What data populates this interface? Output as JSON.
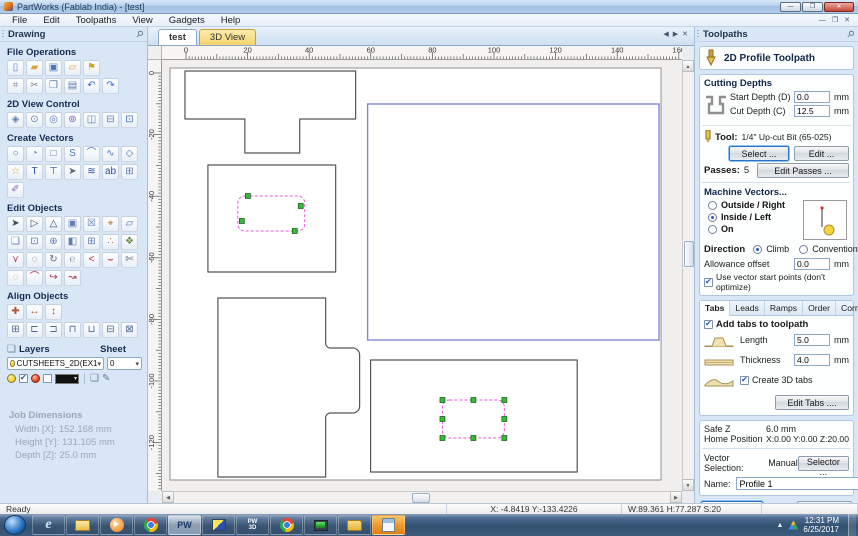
{
  "window": {
    "title": "PartWorks (Fablab India) - [test]"
  },
  "icons": {
    "minimize": "—",
    "restore": "❐",
    "close": "✕",
    "pin": "⚲",
    "arrow_left": "◀",
    "arrow_right": "▶",
    "up": "▲",
    "down": "▼",
    "left": "◀",
    "right": "▶",
    "caret": "▾",
    "play": "▶",
    "layers_stack": "❏",
    "layer_edit": "✎",
    "layers_head": "❏"
  },
  "menu": [
    {
      "name": "menu-file",
      "label": "File"
    },
    {
      "name": "menu-edit",
      "label": "Edit"
    },
    {
      "name": "menu-toolpaths",
      "label": "Toolpaths"
    },
    {
      "name": "menu-view",
      "label": "View"
    },
    {
      "name": "menu-gadgets",
      "label": "Gadgets"
    },
    {
      "name": "menu-help",
      "label": "Help"
    }
  ],
  "left_panel": {
    "header": "Drawing",
    "sections": {
      "file_operations": "File Operations",
      "view_control": "2D View Control",
      "create_vectors": "Create Vectors",
      "edit_objects": "Edit Objects",
      "align_objects": "Align Objects"
    },
    "file_ops_row1": [
      {
        "name": "new-file-icon",
        "g": "▯",
        "c": "#5f7fb5"
      },
      {
        "name": "open-file-icon",
        "g": "▰",
        "c": "#dca63e"
      },
      {
        "name": "save-file-icon",
        "g": "▣",
        "c": "#4f74b8"
      },
      {
        "name": "import-vectors-icon",
        "g": "▱",
        "c": "#dca63e"
      },
      {
        "name": "export-vectors-icon",
        "g": "⚑",
        "c": "#d7a430"
      }
    ],
    "file_ops_row2": [
      {
        "name": "job-setup-icon",
        "g": "⌗",
        "c": "#7c8aa0"
      },
      {
        "name": "cut-icon",
        "g": "✂",
        "c": "#7c8aa0"
      },
      {
        "name": "copy-icon",
        "g": "❐",
        "c": "#5f7fb5"
      },
      {
        "name": "paste-icon",
        "g": "▤",
        "c": "#5f7fb5"
      },
      {
        "name": "undo-icon",
        "g": "↶",
        "c": "#3f6fc4"
      },
      {
        "name": "redo-icon",
        "g": "↷",
        "c": "#3f6fc4"
      }
    ],
    "view_row": [
      {
        "name": "pan-view-icon",
        "g": "◈",
        "c": "#5f7fb5"
      },
      {
        "name": "zoom-interactive-icon",
        "g": "⊙",
        "c": "#5f7fb5"
      },
      {
        "name": "zoom-box-icon",
        "g": "◎",
        "c": "#5f7fb5"
      },
      {
        "name": "zoom-selected-icon",
        "g": "⊚",
        "c": "#7a5fb5"
      },
      {
        "name": "zoom-extents-icon",
        "g": "◫",
        "c": "#5f7fb5"
      },
      {
        "name": "zoom-width-icon",
        "g": "⊟",
        "c": "#5f7fb5"
      },
      {
        "name": "switch-3d-view-icon",
        "g": "⊡",
        "c": "#3f6fc4"
      }
    ],
    "create_row1": [
      {
        "name": "draw-circle-icon",
        "g": "○",
        "c": "#4f74b8"
      },
      {
        "name": "draw-ellipse-icon",
        "g": "◔",
        "c": "#4f74b8"
      },
      {
        "name": "draw-rectangle-icon",
        "g": "□",
        "c": "#4f74b8"
      },
      {
        "name": "draw-polyline-icon",
        "g": "S",
        "c": "#4f74b8"
      },
      {
        "name": "draw-arc-icon",
        "g": "⌒",
        "c": "#4f74b8"
      },
      {
        "name": "draw-curve-icon",
        "g": "∿",
        "c": "#4f74b8"
      },
      {
        "name": "draw-polygon-icon",
        "g": "◇",
        "c": "#4f74b8"
      }
    ],
    "create_row2": [
      {
        "name": "draw-star-icon",
        "g": "☆",
        "c": "#d7a430"
      },
      {
        "name": "draw-text-icon",
        "g": "T",
        "c": "#2d4fa0"
      },
      {
        "name": "text-box-icon",
        "g": "⊤",
        "c": "#2d4fa0"
      },
      {
        "name": "select-text-icon",
        "g": "➤",
        "c": "#5a6a80"
      },
      {
        "name": "text-on-curve-icon",
        "g": "≋",
        "c": "#2d4fa0"
      },
      {
        "name": "convert-text-icon",
        "g": "ab",
        "c": "#2d4fa0"
      },
      {
        "name": "vector-texture-icon",
        "g": "⊞",
        "c": "#5f7fb5"
      }
    ],
    "create_row3": [
      {
        "name": "draw-freehand-icon",
        "g": "✐",
        "c": "#8a6aa8"
      }
    ],
    "edit_row1": [
      {
        "name": "select-tool-icon",
        "g": "➤",
        "c": "#3a4a60"
      },
      {
        "name": "node-edit-tool-icon",
        "g": "▷",
        "c": "#3a4a60"
      },
      {
        "name": "transform-tool-icon",
        "g": "△",
        "c": "#3a4a60"
      },
      {
        "name": "group-objects-icon",
        "g": "▣",
        "c": "#5f7fb5"
      },
      {
        "name": "ungroup-objects-icon",
        "g": "☒",
        "c": "#5f7fb5"
      },
      {
        "name": "measure-tool-icon",
        "g": "⌖",
        "c": "#b06a30"
      },
      {
        "name": "distort-object-icon",
        "g": "▱",
        "c": "#4f74b8"
      }
    ],
    "edit_row2": [
      {
        "name": "offset-vectors-icon",
        "g": "❏",
        "c": "#5f7fb5"
      },
      {
        "name": "scale-object-icon",
        "g": "⊡",
        "c": "#5f7fb5"
      },
      {
        "name": "move-object-icon",
        "g": "⊕",
        "c": "#5f7fb5"
      },
      {
        "name": "mirror-object-icon",
        "g": "◧",
        "c": "#5f7fb5"
      },
      {
        "name": "array-copy-icon",
        "g": "⊞",
        "c": "#5f7fb5"
      },
      {
        "name": "copy-along-vector-icon",
        "g": "∴",
        "c": "#b06a30"
      },
      {
        "name": "nesting-icon",
        "g": "❖",
        "c": "#6a8a4a"
      }
    ],
    "edit_row3": [
      {
        "name": "join-vectors-icon",
        "g": "⋎",
        "c": "#b03050"
      },
      {
        "name": "close-vector-icon",
        "g": "◌",
        "c": "#5a6a80"
      },
      {
        "name": "smooth-vector-icon",
        "g": "↻",
        "c": "#5a6a80"
      },
      {
        "name": "curve-fit-icon",
        "g": "℮",
        "c": "#8a9ab0"
      },
      {
        "name": "arc-fit-icon",
        "g": "<",
        "c": "#b03030"
      },
      {
        "name": "bezier-fit-icon",
        "g": "⌣",
        "c": "#b03030"
      },
      {
        "name": "cut-vector-icon",
        "g": "✄",
        "c": "#5a6a80"
      }
    ],
    "edit_row4": [
      {
        "name": "edit-selected-blob-icon",
        "g": "◌",
        "c": "#d9a415"
      },
      {
        "name": "arc-segment-icon",
        "g": "⌒",
        "c": "#b03050"
      },
      {
        "name": "arc-direction-icon",
        "g": "↪",
        "c": "#b03050"
      },
      {
        "name": "reverse-direction-icon",
        "g": "↝",
        "c": "#b03050"
      }
    ],
    "align_row1": [
      {
        "name": "center-in-material-icon",
        "g": "✚",
        "c": "#b05a30"
      },
      {
        "name": "center-x-icon",
        "g": "↔",
        "c": "#b05a30"
      },
      {
        "name": "center-y-icon",
        "g": "↕",
        "c": "#b05a30"
      }
    ],
    "align_row2": [
      {
        "name": "align-center-icon",
        "g": "⊞",
        "c": "#4f6a90"
      },
      {
        "name": "align-left-icon",
        "g": "⊏",
        "c": "#4f6a90"
      },
      {
        "name": "align-right-icon",
        "g": "⊐",
        "c": "#4f6a90"
      },
      {
        "name": "align-top-icon",
        "g": "⊓",
        "c": "#4f6a90"
      },
      {
        "name": "align-bottom-icon",
        "g": "⊔",
        "c": "#4f6a90"
      },
      {
        "name": "space-horizontal-icon",
        "g": "⊟",
        "c": "#4f6a90"
      },
      {
        "name": "space-vertical-icon",
        "g": "⊠",
        "c": "#4f6a90"
      }
    ],
    "layers": {
      "label": "Layers",
      "sheet_label": "Sheet",
      "layer_value": "CUTSHEETS_2D(EX1",
      "sheet_value": "0"
    },
    "job_dimensions": {
      "title": "Job Dimensions",
      "width_label": "Width  [X]:",
      "width_value": "152.168 mm",
      "height_label": "Height [Y]:",
      "height_value": "131.105 mm",
      "depth_label": "Depth  [Z]:",
      "depth_value": "25.0 mm"
    }
  },
  "canvas": {
    "tabs": [
      {
        "name": "tab-test",
        "label": "test",
        "active": true
      },
      {
        "name": "tab-3d-view",
        "label": "3D View",
        "cls": "yellow"
      }
    ],
    "ruler_top_labels": [
      0,
      20,
      40,
      60,
      80,
      100,
      120,
      140
    ],
    "ruler_left_labels": [
      0,
      -20,
      -40,
      -60,
      -80,
      -100,
      -120
    ],
    "shapes": [
      {
        "type": "rect",
        "cls": "page-rect",
        "x": 8,
        "y": 8,
        "w": 492,
        "h": 412
      },
      {
        "type": "polygon",
        "cls": "outline",
        "points": "23,11 194,11 194,59 138,59 138,93 83,93 83,59 23,59"
      },
      {
        "type": "rect",
        "cls": "outline",
        "x": 46,
        "y": 105,
        "w": 128,
        "h": 107
      },
      {
        "type": "rrect",
        "cls": "dashed",
        "x": 76,
        "y": 136,
        "w": 67,
        "h": 35,
        "r": 7,
        "handles": [
          [
            86,
            136
          ],
          [
            139,
            146
          ],
          [
            80,
            161
          ],
          [
            133,
            171
          ]
        ]
      },
      {
        "type": "rect",
        "cls": "sel-blue",
        "x": 206,
        "y": 44,
        "w": 292,
        "h": 236
      },
      {
        "type": "path",
        "cls": "outline",
        "d": "M56,238 L164,238 L164,282 A5,5 0 0 0 169,288 L190,288 A7,7 0 0 1 198,295 L198,346 A7,7 0 0 1 190,353 L169,353 A5,5 0 0 0 164,359 L164,417 L56,417 Z"
      },
      {
        "type": "rect",
        "cls": "outline",
        "x": 209,
        "y": 300,
        "w": 207,
        "h": 112
      },
      {
        "type": "rrect",
        "cls": "dashed",
        "x": 281,
        "y": 340,
        "w": 62,
        "h": 38,
        "r": 7,
        "handles": [
          [
            281,
            340
          ],
          [
            312,
            340
          ],
          [
            343,
            340
          ],
          [
            281,
            359
          ],
          [
            343,
            359
          ],
          [
            281,
            378
          ],
          [
            312,
            378
          ],
          [
            343,
            378
          ]
        ]
      }
    ]
  },
  "right_panel": {
    "header": "Toolpaths",
    "toolpath_title": "2D Profile Toolpath",
    "cutting_depths": {
      "title": "Cutting Depths",
      "start_label": "Start Depth (D)",
      "start_value": "0.0",
      "cut_label": "Cut Depth (C)",
      "cut_value": "12.5",
      "unit": "mm"
    },
    "tool": {
      "label": "Tool:",
      "value": "1/4\" Up-cut Bit (65-025)",
      "select_btn": "Select ...",
      "edit_btn": "Edit ..."
    },
    "passes": {
      "label": "Passes:",
      "value": "5",
      "edit_btn": "Edit Passes ..."
    },
    "machine_vectors": {
      "title": "Machine Vectors...",
      "options": [
        {
          "name": "radio-outside-right",
          "label": "Outside / Right",
          "selected": false
        },
        {
          "name": "radio-inside-left",
          "label": "Inside / Left",
          "selected": true
        },
        {
          "name": "radio-on",
          "label": "On",
          "selected": false
        }
      ],
      "direction_label": "Direction",
      "climb_label": "Climb",
      "conventional_label": "Conventional",
      "allowance_label": "Allowance offset",
      "allowance_value": "0.0",
      "unit": "mm",
      "start_points_label": "Use vector start points (don't optimize)",
      "start_points_checked": true
    },
    "tabs_panel": {
      "tabs": [
        {
          "name": "tab-tabs",
          "label": "Tabs",
          "active": true
        },
        {
          "name": "tab-leads",
          "label": "Leads"
        },
        {
          "name": "tab-ramps",
          "label": "Ramps"
        },
        {
          "name": "tab-order",
          "label": "Order"
        },
        {
          "name": "tab-corners",
          "label": "Corners"
        }
      ],
      "add_tabs_label": "Add tabs to toolpath",
      "length_label": "Length",
      "length_value": "5.0",
      "thickness_label": "Thickness",
      "thickness_value": "4.0",
      "unit": "mm",
      "create_3d_label": "Create 3D tabs",
      "edit_tabs_btn": "Edit Tabs ...."
    },
    "position": {
      "safez_label": "Safe Z",
      "safez_value": "6.0 mm",
      "home_label": "Home Position",
      "home_value": "X:0.00 Y:0.00 Z:20.00"
    },
    "selection": {
      "label": "Vector Selection:",
      "value": "Manual",
      "selector_btn": "Selector ..."
    },
    "name_field": {
      "label": "Name:",
      "value": "Profile 1"
    },
    "actions": {
      "calculate": "Calculate",
      "close": "Close"
    }
  },
  "status_bar": {
    "ready": "Ready",
    "xy": "X: -4.8419 Y:-133.4226",
    "whs": "W:89.361  H:77.287  S:20"
  },
  "taskbar": {
    "items": [
      {
        "name": "taskbar-ie",
        "kind": "ie"
      },
      {
        "name": "taskbar-explorer",
        "kind": "exp"
      },
      {
        "name": "taskbar-media-player",
        "kind": "wmp"
      },
      {
        "name": "taskbar-chrome",
        "kind": "chrome"
      },
      {
        "name": "taskbar-partworks",
        "kind": "pw",
        "label": "PW",
        "active": true
      },
      {
        "name": "taskbar-vcarve-app",
        "kind": "vc"
      },
      {
        "name": "taskbar-partworks-3d",
        "kind": "pw3d",
        "label": "PW 3D"
      },
      {
        "name": "taskbar-chrome-alt",
        "kind": "chrome"
      },
      {
        "name": "taskbar-system-monitor",
        "kind": "mon"
      },
      {
        "name": "taskbar-folder",
        "kind": "folder"
      },
      {
        "name": "taskbar-calculator",
        "kind": "calc",
        "attention": true
      }
    ],
    "tray": {
      "time": "12:31 PM",
      "date": "6/25/2017"
    }
  }
}
